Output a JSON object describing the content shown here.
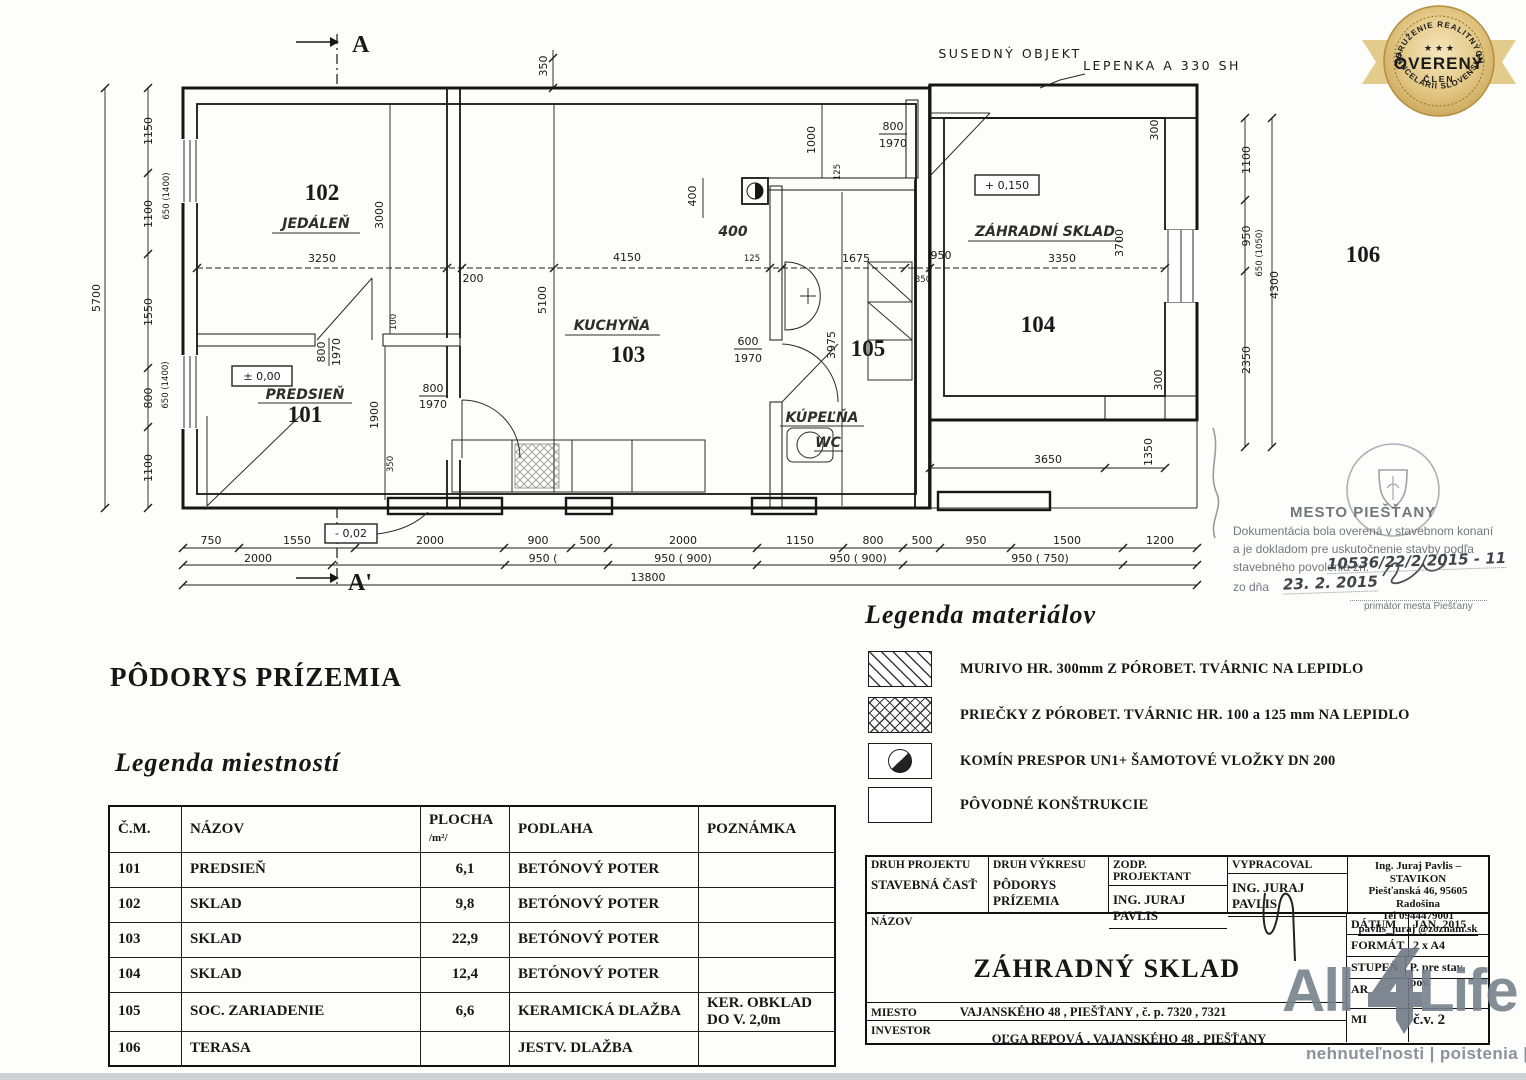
{
  "headings": {
    "plan_title": "PÔDORYS PRÍZEMIA",
    "rooms_legend": "Legenda miestností",
    "materials_legend": "Legenda materiálov"
  },
  "badge": {
    "top_arc": "ZDRUŽENIE REALITNÝCH",
    "stars": "★ ★ ★",
    "center": "OVERENÝ",
    "sub": "ČLEN",
    "bottom_arc": "KANCELÁRIÍ SLOVENSKA"
  },
  "plan": {
    "labels": {
      "secA": "A",
      "secA2": "A'",
      "susedny": "SUSEDNÝ OBJEKT",
      "lepenka": "LEPENKA A 330 SH",
      "L1": "1150",
      "L1a": "650 (1400)",
      "L2": "1100",
      "L3": "1550",
      "L3a": "650 (1400)",
      "L4": "800",
      "L5": "1100",
      "Ltot": "5700",
      "r102": "102",
      "r102n": "JEDÁLEŇ",
      "d3250": "3250",
      "d3000": "3000",
      "d200": "200",
      "d4150": "4150",
      "d5100": "5100",
      "r103": "103",
      "r103n": "KUCHYŇA",
      "d125": "125",
      "d125b": "125",
      "d1675": "1675",
      "d950m": "950",
      "d350m": "350",
      "d3350": "3350",
      "d3700": "3700",
      "r104": "104",
      "sklad": "ZÁHRADNÍ SKLAD",
      "lvlp": "+ 0,150",
      "lvl0": "± 0,00",
      "lvlm": "- 0,02",
      "r101": "101",
      "r101n": "PREDSIEŇ",
      "d100": "100",
      "d1900": "1900",
      "d350b": "350",
      "d400a": "400",
      "d400b": "400",
      "d1000": "1000",
      "d3975": "3975",
      "r105": "105",
      "r105n": "KÚPEĽŇA",
      "r105n2": "WC",
      "d300a": "300",
      "R1": "1100",
      "R2": "950",
      "R2a": "650 (1050)",
      "Rtot": "4300",
      "R3": "2350",
      "r106": "106",
      "d3650": "3650",
      "d1350": "1350",
      "d300b": "300",
      "b1": "750",
      "b2": "1550",
      "b3": "2000",
      "b4": "900",
      "b5": "500",
      "b6": "2000",
      "b7": "1150",
      "b8": "800",
      "b9": "500",
      "b10": "950",
      "b11": "1500",
      "b12": "1200",
      "c1": "2000",
      "c2": "950 (",
      "c3": "950 ( 900)",
      "c4": "950 ( 900)",
      "c5": "950 ( 750)",
      "btot": "13800",
      "d350t": "350"
    },
    "doors": {
      "d0": {
        "w": "800",
        "h": "1970"
      },
      "d1": {
        "w": "800",
        "h": "1970"
      },
      "d2": {
        "w": "800",
        "h": "1970"
      },
      "d3": {
        "w": "600",
        "h": "1970"
      }
    }
  },
  "stamp": {
    "city": "MESTO PIEŠŤANY",
    "line1": "Dokumentácia bola overená v stavebnom konaní",
    "line2": "a je dokladom pre uskutočnenie stavby podľa",
    "line3": "stavebného povolenia zn.",
    "number": "10536/22/2/2015 - 11",
    "line4": "zo dňa",
    "date": "23. 2. 2015",
    "caption": "primátor mesta Piešťany"
  },
  "materials": {
    "items": [
      {
        "label": "MURIVO  HR. 300mm Z PÓROBET. TVÁRNIC  NA LEPIDLO"
      },
      {
        "label": "PRIEČKY  Z PÓROBET. TVÁRNIC HR. 100 a 125 mm NA LEPIDLO"
      },
      {
        "label": "KOMÍN PRESPOR UN1+ ŠAMOTOVÉ VLOŽKY DN 200"
      },
      {
        "label": "PÔVODNÉ KONŠTRUKCIE"
      }
    ]
  },
  "rooms_table": {
    "headers": {
      "cm": "Č.M.",
      "nazov": "NÁZOV",
      "plocha1": "PLOCHA",
      "plocha2": "/m²/",
      "podlaha": "PODLAHA",
      "poznamka": "POZNÁMKA"
    },
    "rows": [
      [
        "101",
        "PREDSIEŇ",
        "6,1",
        "BETÓNOVÝ POTER",
        ""
      ],
      [
        "102",
        "SKLAD",
        "9,8",
        "BETÓNOVÝ POTER",
        ""
      ],
      [
        "103",
        "SKLAD",
        "22,9",
        "BETÓNOVÝ POTER",
        ""
      ],
      [
        "104",
        "SKLAD",
        "12,4",
        "BETÓNOVÝ POTER",
        ""
      ],
      [
        "105",
        "SOC. ZARIADENIE",
        "6,6",
        "KERAMICKÁ DLAŽBA",
        "KER. OBKLAD DO V. 2,0m"
      ],
      [
        "106",
        "TERASA",
        "",
        "JESTV. DLAŽBA",
        ""
      ]
    ]
  },
  "titleblock": {
    "c1_label": "DRUH PROJEKTU",
    "c1_value": "STAVEBNÁ ČASŤ",
    "c2_label": "DRUH VÝKRESU",
    "c2_value": "PÔDORYS PRÍZEMIA",
    "c3_label": "ZODP. PROJEKTANT",
    "c3_value": "ING. JURAJ PAVLIS",
    "c4_label": "VYPRACOVAL",
    "c4_value": "ING. JURAJ  PAVLIS",
    "company1": "Ing. Juraj Pavlis – STAVIKON",
    "company2": "Piešťanská 46, 95605 Radošina",
    "company3": "Tel  0944479001",
    "company4": "pavlis_juraj @zoznam.sk",
    "nazov_label": "NÁZOV",
    "nazov": "ZÁHRADNÝ SKLAD",
    "miesto_label": "MIESTO",
    "miesto": "VAJANSKÉHO 48 , PIEŠŤANY , č. p. 7320 , 7321",
    "investor_label": "INVESTOR",
    "investor": "OĽGA REPOVÁ , VAJANSKÉHO 48 , PIEŠŤANY",
    "meta": [
      {
        "label": "DÁTUM",
        "value": "JAN. 2015"
      },
      {
        "label": "FORMÁT",
        "value": "2 x A4"
      },
      {
        "label": "STUPEŇ",
        "value": "P. pre stav. pov."
      },
      {
        "label": "AR",
        "value": ""
      },
      {
        "label": "MI",
        "value": "č.v. 2"
      }
    ]
  },
  "logo": {
    "part1": "All",
    "part3": "Life",
    "tagline": "nehnuteľnosti | poistenia | úvery"
  }
}
